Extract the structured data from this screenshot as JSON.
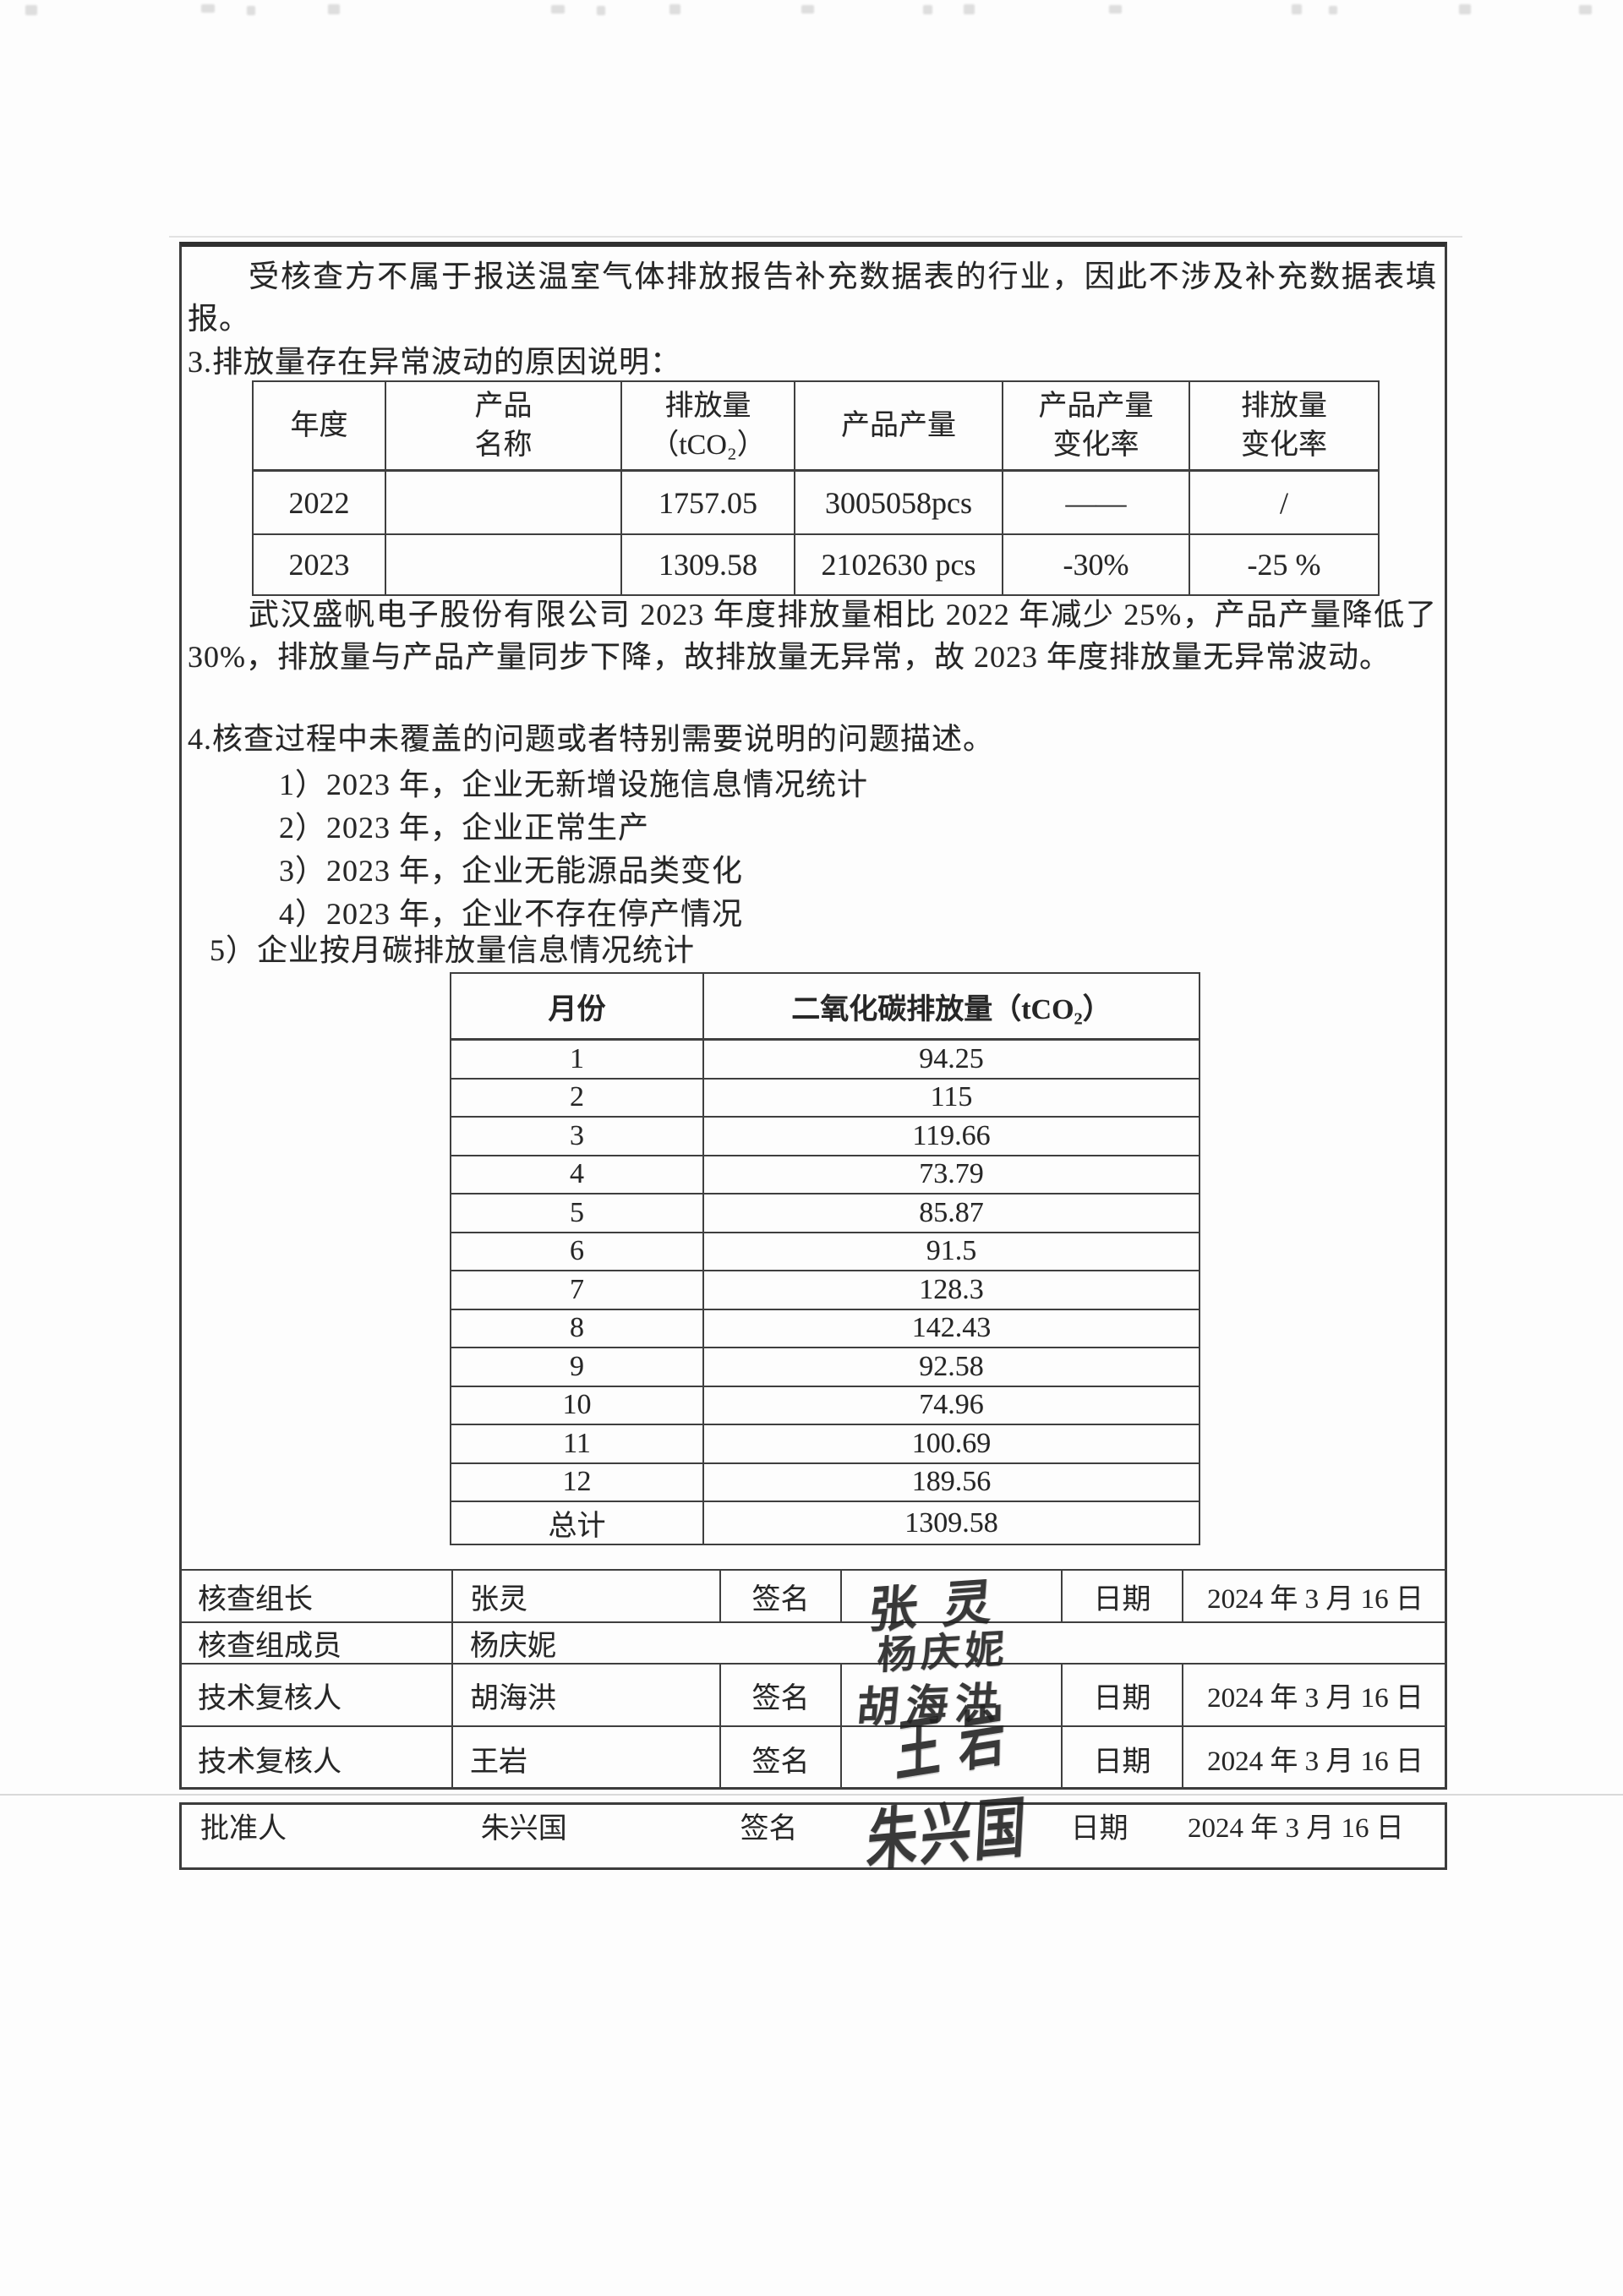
{
  "document": {
    "intro_paragraph": "受核查方不属于报送温室气体排放报告补充数据表的行业，因此不涉及补充数据表填报。",
    "section3_heading": "3.排放量存在异常波动的原因说明：",
    "analysis_paragraph": "武汉盛帆电子股份有限公司 2023 年度排放量相比 2022 年减少 25%，产品产量降低了 30%，排放量与产品产量同步下降，故排放量无异常，故 2023 年度排放量无异常波动。",
    "section4_heading": "4.核查过程中未覆盖的问题或者特别需要说明的问题描述。",
    "section4_items": [
      "1）2023 年，企业无新增设施信息情况统计",
      "2）2023 年，企业正常生产",
      "3）2023 年，企业无能源品类变化",
      "4）2023 年，企业不存在停产情况"
    ],
    "section5_heading": "5）企业按月碳排放量信息情况统计"
  },
  "fluctuation_table": {
    "headers": [
      {
        "line1": "年度",
        "line2": ""
      },
      {
        "line1": "产品",
        "line2": "名称"
      },
      {
        "line1": "排放量",
        "line2": "（tCO₂）"
      },
      {
        "line1": "产品产量",
        "line2": ""
      },
      {
        "line1": "产品产量",
        "line2": "变化率"
      },
      {
        "line1": "排放量",
        "line2": "变化率"
      }
    ],
    "rows": [
      {
        "year": "2022",
        "product": "",
        "emission": "1757.05",
        "output": "3005058pcs",
        "output_change": "——",
        "emission_change": "/"
      },
      {
        "year": "2023",
        "product": "",
        "emission": "1309.58",
        "output": "2102630 pcs",
        "output_change": "-30%",
        "emission_change": "-25 %"
      }
    ]
  },
  "monthly_table": {
    "month_header": "月份",
    "emission_header": "二氧化碳排放量（tCO₂）",
    "rows": [
      {
        "month": "1",
        "value": "94.25"
      },
      {
        "month": "2",
        "value": "115"
      },
      {
        "month": "3",
        "value": "119.66"
      },
      {
        "month": "4",
        "value": "73.79"
      },
      {
        "month": "5",
        "value": "85.87"
      },
      {
        "month": "6",
        "value": "91.5"
      },
      {
        "month": "7",
        "value": "128.3"
      },
      {
        "month": "8",
        "value": "142.43"
      },
      {
        "month": "9",
        "value": "92.58"
      },
      {
        "month": "10",
        "value": "74.96"
      },
      {
        "month": "11",
        "value": "100.69"
      },
      {
        "month": "12",
        "value": "189.56"
      },
      {
        "month": "总计",
        "value": "1309.58"
      }
    ]
  },
  "signatures": {
    "rows": [
      {
        "role": "核查组长",
        "name": "张灵",
        "sign_label": "签名",
        "signature": "张灵",
        "date_label": "日期",
        "date": "2024 年 3 月 16 日"
      },
      {
        "role": "核查组成员",
        "name": "杨庆妮",
        "sign_label": "",
        "signature": "杨庆妮",
        "date_label": "",
        "date": ""
      },
      {
        "role": "技术复核人",
        "name": "胡海洪",
        "sign_label": "签名",
        "signature": "胡海洪",
        "date_label": "日期",
        "date": "2024 年 3 月 16 日"
      },
      {
        "role": "技术复核人",
        "name": "王岩",
        "sign_label": "签名",
        "signature": "王岩",
        "date_label": "日期",
        "date": "2024 年 3 月 16 日"
      },
      {
        "role": "批准人",
        "name": "朱兴国",
        "sign_label": "签名",
        "signature": "朱兴国",
        "date_label": "日期",
        "date": "2024 年 3 月 16 日"
      }
    ]
  }
}
